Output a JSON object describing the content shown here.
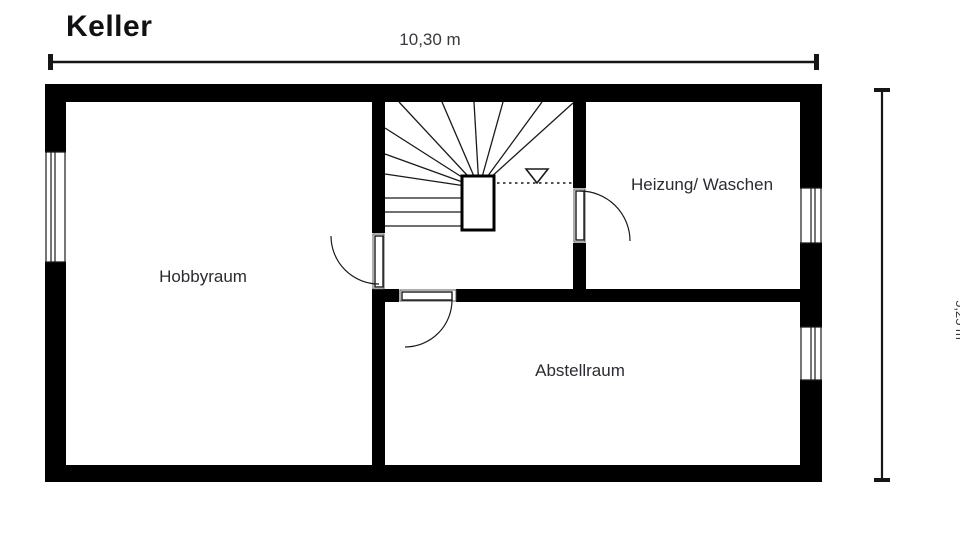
{
  "title": "Keller",
  "dimensions": {
    "width_label": "10,30 m",
    "height_label": "5,25 m"
  },
  "rooms": [
    {
      "id": "hobbyraum",
      "label": "Hobbyraum"
    },
    {
      "id": "heizung_waschen",
      "label": "Heizung/ Waschen"
    },
    {
      "id": "abstellraum",
      "label": "Abstellraum"
    }
  ],
  "features": {
    "stairs": "winder-staircase-with-direction-triangle",
    "doors": 3,
    "windows": 3
  },
  "colors": {
    "wall": "#000000",
    "line": "#1a1a1a",
    "frame_line": "#4a4a4a",
    "room_text": "#2b2b31",
    "dim_text": "#3a3a3e",
    "background": "#ffffff"
  }
}
